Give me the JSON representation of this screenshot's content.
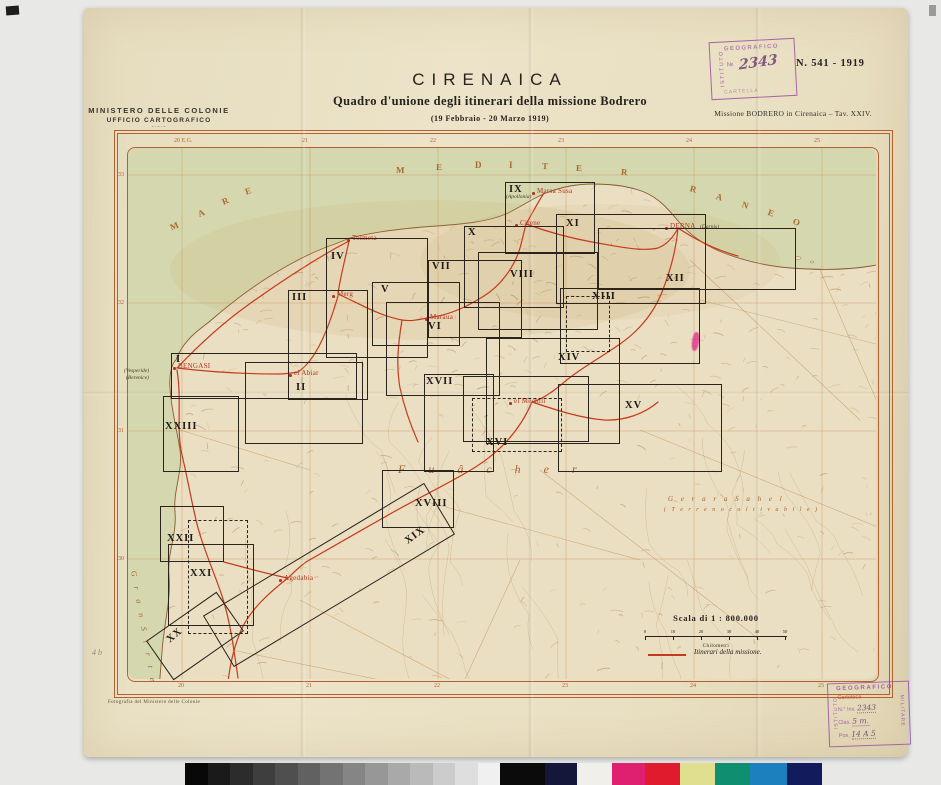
{
  "header": {
    "ministry_line1": "MINISTERO DELLE COLONIE",
    "ministry_line2": "UFFICIO CARTOGRAFICO",
    "ministry_dash": "-·-·-",
    "title": "CIRENAICA",
    "subtitle": "Quadro d'unione degli itinerari della missione Bodrero",
    "date_line": "(19 Febbraio - 20 Marzo 1919)",
    "doc_number": "N. 541 - 1919",
    "mission_line": "Missione BODRERO in Cirenaica – Tav. XXIV."
  },
  "stamps": {
    "top": {
      "org_vertical": "ISTITUTO",
      "line1": "GEOGRAFICO",
      "number_label": "№",
      "number_hand": "2343",
      "line2": "CARTELLA"
    },
    "bottom": {
      "arc": "GEOGRAFICO",
      "left_vertical": "ISTITUTO",
      "right_vertical": "MILITARE",
      "cartoteca": "Cartoteca",
      "inv_label": "N.° Inv.",
      "inv_value": "2343",
      "clas_label": "Clas.",
      "clas_value": "5 m.",
      "pos_label": "Pos.",
      "pos_value": "14 A 5"
    }
  },
  "map": {
    "colors": {
      "frame": "#b5612f",
      "sea": "#d5d8ae",
      "land": "#eadfc2",
      "coast": "#8a5a30",
      "route": "#c63a1c",
      "track": "#b97a3e",
      "graticule": "#c07a3a",
      "terrain": "#a06a38"
    },
    "sea_letters_mare": [
      [
        "M",
        170,
        221,
        -24
      ],
      [
        "A",
        198,
        208,
        -24
      ],
      [
        "R",
        222,
        196,
        -22
      ],
      [
        "E",
        245,
        186,
        -18
      ]
    ],
    "sea_letters_mediterraneo": [
      [
        "M",
        396,
        165,
        3
      ],
      [
        "E",
        436,
        162,
        1
      ],
      [
        "D",
        475,
        160,
        0
      ],
      [
        "I",
        509,
        160,
        0
      ],
      [
        "T",
        542,
        161,
        1
      ],
      [
        "E",
        576,
        163,
        2
      ],
      [
        "R",
        621,
        167,
        5
      ],
      [
        "R",
        690,
        184,
        14
      ],
      [
        "A",
        716,
        192,
        16
      ],
      [
        "N",
        742,
        200,
        18
      ],
      [
        "E",
        768,
        208,
        20
      ],
      [
        "O",
        793,
        217,
        22
      ]
    ],
    "region_labels": [
      {
        "text": "F u â c h e r",
        "x": 398,
        "y": 462,
        "size": 12,
        "ls": 10,
        "rot": 0
      },
      {
        "text": "G e r a r a   S a h e l",
        "x": 668,
        "y": 495,
        "size": 7,
        "ls": 3,
        "rot": 0
      },
      {
        "text": "( T e r r e n o   c o l t i v a b i l e )",
        "x": 664,
        "y": 507,
        "size": 6,
        "ls": 2,
        "rot": 0
      },
      {
        "text": "G r a n   S i r t e",
        "x": 138,
        "y": 570,
        "size": 8,
        "ls": 4,
        "rot": 80
      }
    ],
    "towns": [
      {
        "name": "BENGASI",
        "x": 178,
        "y": 362
      },
      {
        "name": "Tolmeta",
        "x": 352,
        "y": 234
      },
      {
        "name": "Merg",
        "x": 337,
        "y": 290
      },
      {
        "name": "Maraua",
        "x": 430,
        "y": 313
      },
      {
        "name": "Cirene",
        "x": 520,
        "y": 219
      },
      {
        "name": "Marsa Susa",
        "x": 537,
        "y": 187
      },
      {
        "name": "DERNA",
        "x": 670,
        "y": 222
      },
      {
        "name": "el Abiar",
        "x": 294,
        "y": 369
      },
      {
        "name": "Agedabia",
        "x": 284,
        "y": 574
      },
      {
        "name": "el Mechili",
        "x": 514,
        "y": 397
      }
    ],
    "land_labels": [
      {
        "text": "(Vesperide)",
        "x": 124,
        "y": 368
      },
      {
        "text": "(Berenice)",
        "x": 126,
        "y": 375
      },
      {
        "text": "(Apollonia)",
        "x": 506,
        "y": 194
      },
      {
        "text": "(Darnis)",
        "x": 700,
        "y": 224
      }
    ],
    "sheets": [
      {
        "n": "I",
        "r": [
          171,
          353,
          184,
          44
        ],
        "l": [
          176,
          354
        ]
      },
      {
        "n": "II",
        "r": [
          245,
          362,
          116,
          80
        ],
        "l": [
          296,
          382
        ]
      },
      {
        "n": "III",
        "r": [
          288,
          290,
          78,
          108
        ],
        "l": [
          292,
          292
        ]
      },
      {
        "n": "IV",
        "r": [
          326,
          238,
          100,
          118
        ],
        "l": [
          331,
          251
        ]
      },
      {
        "n": "V",
        "r": [
          372,
          282,
          86,
          62
        ],
        "l": [
          381,
          284
        ]
      },
      {
        "n": "VI",
        "r": [
          386,
          302,
          112,
          92
        ],
        "l": [
          428,
          321
        ]
      },
      {
        "n": "VII",
        "r": [
          428,
          260,
          92,
          76
        ],
        "l": [
          432,
          261
        ]
      },
      {
        "n": "VIII",
        "r": [
          478,
          252,
          118,
          76
        ],
        "l": [
          510,
          269
        ]
      },
      {
        "n": "IX",
        "r": [
          505,
          182,
          88,
          70
        ],
        "l": [
          509,
          184
        ]
      },
      {
        "n": "X",
        "r": [
          464,
          226,
          98,
          80
        ],
        "l": [
          468,
          227
        ]
      },
      {
        "n": "XI",
        "r": [
          556,
          214,
          148,
          88
        ],
        "l": [
          566,
          218
        ]
      },
      {
        "n": "XII",
        "r": [
          598,
          228,
          196,
          60
        ],
        "l": [
          666,
          273
        ]
      },
      {
        "n": "XIII",
        "r": [
          560,
          288,
          138,
          74
        ],
        "l": [
          592,
          291
        ]
      },
      {
        "n": "XIV",
        "r": [
          486,
          338,
          132,
          104
        ],
        "l": [
          558,
          352
        ]
      },
      {
        "n": "XV",
        "r": [
          558,
          384,
          162,
          86
        ],
        "l": [
          625,
          400
        ]
      },
      {
        "n": "XVI",
        "r": [
          463,
          376,
          124,
          64
        ],
        "l": [
          486,
          437
        ]
      },
      {
        "n": "XVII",
        "r": [
          424,
          374,
          68,
          96
        ],
        "l": [
          426,
          376
        ]
      },
      {
        "n": "XVIII",
        "r": [
          382,
          470,
          70,
          56
        ],
        "l": [
          415,
          498
        ]
      },
      {
        "n": "XIX",
        "r": [
          200,
          545,
          256,
          58
        ],
        "rot": -31,
        "l": [
          404,
          530
        ],
        "lrot": -36
      },
      {
        "n": "XX",
        "r": [
          152,
          612,
          84,
          46
        ],
        "rot": -35,
        "l": [
          166,
          630
        ],
        "lrot": -40
      },
      {
        "n": "XXI",
        "r": [
          168,
          544,
          84,
          80
        ],
        "l": [
          190,
          568
        ]
      },
      {
        "n": "XXII",
        "r": [
          160,
          506,
          62,
          54
        ],
        "l": [
          167,
          533
        ]
      },
      {
        "n": "XXIII",
        "r": [
          163,
          396,
          74,
          74
        ],
        "l": [
          165,
          421
        ]
      },
      {
        "n": "",
        "r": [
          188,
          520,
          58,
          112
        ],
        "dash": true,
        "l": [
          0,
          0
        ]
      },
      {
        "n": "",
        "r": [
          566,
          296,
          42,
          54
        ],
        "dash": true,
        "l": [
          0,
          0
        ]
      },
      {
        "n": "",
        "r": [
          472,
          398,
          88,
          52
        ],
        "dash": true,
        "l": [
          0,
          0
        ]
      }
    ],
    "graticule": {
      "meridians": [
        182,
        310,
        438,
        566,
        694,
        822
      ],
      "parallels": [
        175,
        303,
        431,
        559,
        687
      ],
      "top_labels": [
        "20 E.G.",
        "21",
        "22",
        "23",
        "24",
        "25"
      ],
      "bottom_labels": [
        "20",
        "21",
        "22",
        "23",
        "24",
        "25"
      ],
      "left_labels": [
        "33",
        "32",
        "31",
        "30"
      ]
    },
    "scale": {
      "title": "Scala di 1 : 800.000",
      "ticks": [
        "0",
        "10",
        "20",
        "30",
        "40",
        "50"
      ],
      "unit": "Chilometri"
    },
    "legend_label": "Itinerari della missione.",
    "credit": "Fotografia del Ministero delle Colonie",
    "pencil_note": "4 b"
  },
  "colorbar": {
    "gray_steps": 14,
    "gray_width": 315,
    "colors": [
      {
        "hex": "#0b0b0b",
        "w": 45
      },
      {
        "hex": "#15173a",
        "w": 32
      },
      {
        "hex": "#f1efe9",
        "w": 35
      },
      {
        "hex": "#df2070",
        "w": 33
      },
      {
        "hex": "#e01a2f",
        "w": 35
      },
      {
        "hex": "#dfdf8d",
        "w": 35
      },
      {
        "hex": "#0f8f6f",
        "w": 35
      },
      {
        "hex": "#1c80bf",
        "w": 37
      },
      {
        "hex": "#121c5c",
        "w": 35
      }
    ]
  }
}
